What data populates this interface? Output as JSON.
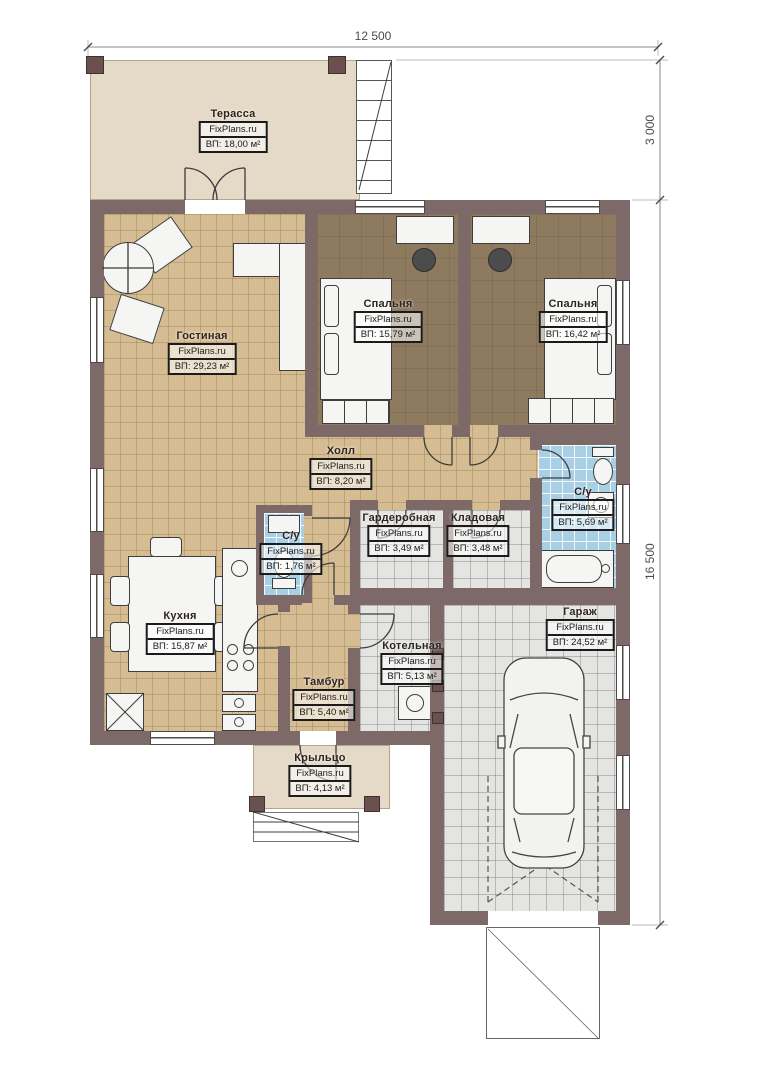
{
  "dimensions": {
    "top_width": "12 500",
    "right_top": "3 000",
    "right_total": "16 500"
  },
  "rooms": [
    {
      "name": "Терасса",
      "brand": "FixPlans.ru",
      "area": "ВП: 18,00 м²"
    },
    {
      "name": "Гостиная",
      "brand": "FixPlans.ru",
      "area": "ВП: 29,23 м²"
    },
    {
      "name": "Спальня",
      "brand": "FixPlans.ru",
      "area": "ВП: 15,79 м²"
    },
    {
      "name": "Спальня",
      "brand": "FixPlans.ru",
      "area": "ВП: 16,42 м²"
    },
    {
      "name": "Холл",
      "brand": "FixPlans.ru",
      "area": "ВП: 8,20 м²"
    },
    {
      "name": "Гардеробная",
      "brand": "FixPlans.ru",
      "area": "ВП: 3,49 м²"
    },
    {
      "name": "Кладовая",
      "brand": "FixPlans.ru",
      "area": "ВП: 3,48 м²"
    },
    {
      "name": "С/у",
      "brand": "FixPlans.ru",
      "area": "ВП: 5,69 м²"
    },
    {
      "name": "С/у",
      "brand": "FixPlans.ru",
      "area": "ВП: 1,76 м²"
    },
    {
      "name": "Кухня",
      "brand": "FixPlans.ru",
      "area": "ВП: 15,87 м²"
    },
    {
      "name": "Котельная",
      "brand": "FixPlans.ru",
      "area": "ВП: 5,13 м²"
    },
    {
      "name": "Тамбур",
      "brand": "FixPlans.ru",
      "area": "ВП: 5,40 м²"
    },
    {
      "name": "Гараж",
      "brand": "FixPlans.ru",
      "area": "ВП: 24,52 м²"
    },
    {
      "name": "Крыльцо",
      "brand": "FixPlans.ru",
      "area": "ВП: 4,13 м²"
    }
  ],
  "palette": {
    "wall": "#7d6a68",
    "parquet": "#d6bc92",
    "bedroom_floor": "#8d7a5f",
    "tile_gray": "#e4e4e2",
    "tile_blue": "#a9cfe5",
    "terrace": "#e5dac7"
  }
}
